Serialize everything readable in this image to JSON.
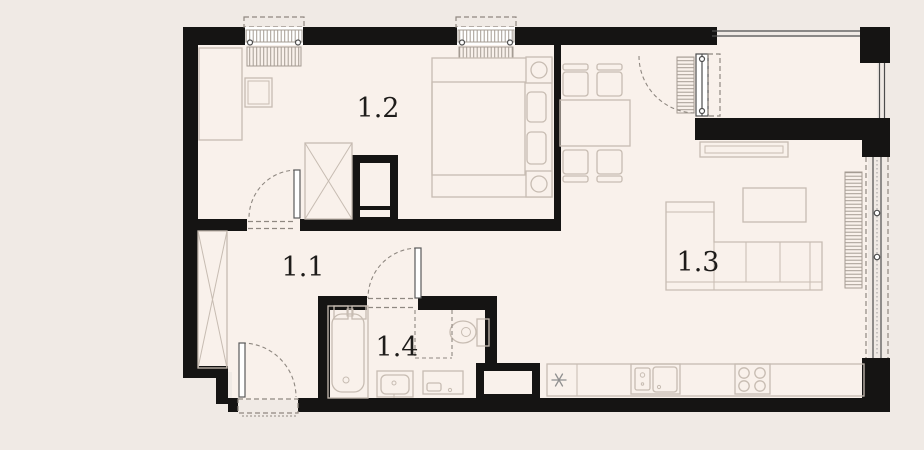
{
  "floorplan": {
    "title": "apartment-floor-plan",
    "rooms": [
      {
        "label": "1.1",
        "name": "hallway"
      },
      {
        "label": "1.2",
        "name": "bedroom"
      },
      {
        "label": "1.3",
        "name": "living-room-kitchen"
      },
      {
        "label": "1.4",
        "name": "bathroom"
      }
    ],
    "fixtures": [
      "double-bed",
      "nightstand",
      "wardrobe",
      "desk",
      "chair",
      "bathtub",
      "toilet",
      "washbasin",
      "washing-machine",
      "kitchen-counter",
      "sink",
      "stove",
      "fridge-snowflake",
      "dining-table",
      "dining-chair",
      "tv-stand",
      "coffee-table",
      "corner-sofa",
      "radiator",
      "balcony",
      "window",
      "door",
      "duct-shaft"
    ],
    "colors": {
      "wall": "#151413",
      "floor": "#f9f1eb",
      "background": "#f0eae5",
      "furniture_line": "#c7bcb2",
      "opening_dash": "#8f8881",
      "frame": "#4d4d4d"
    }
  }
}
